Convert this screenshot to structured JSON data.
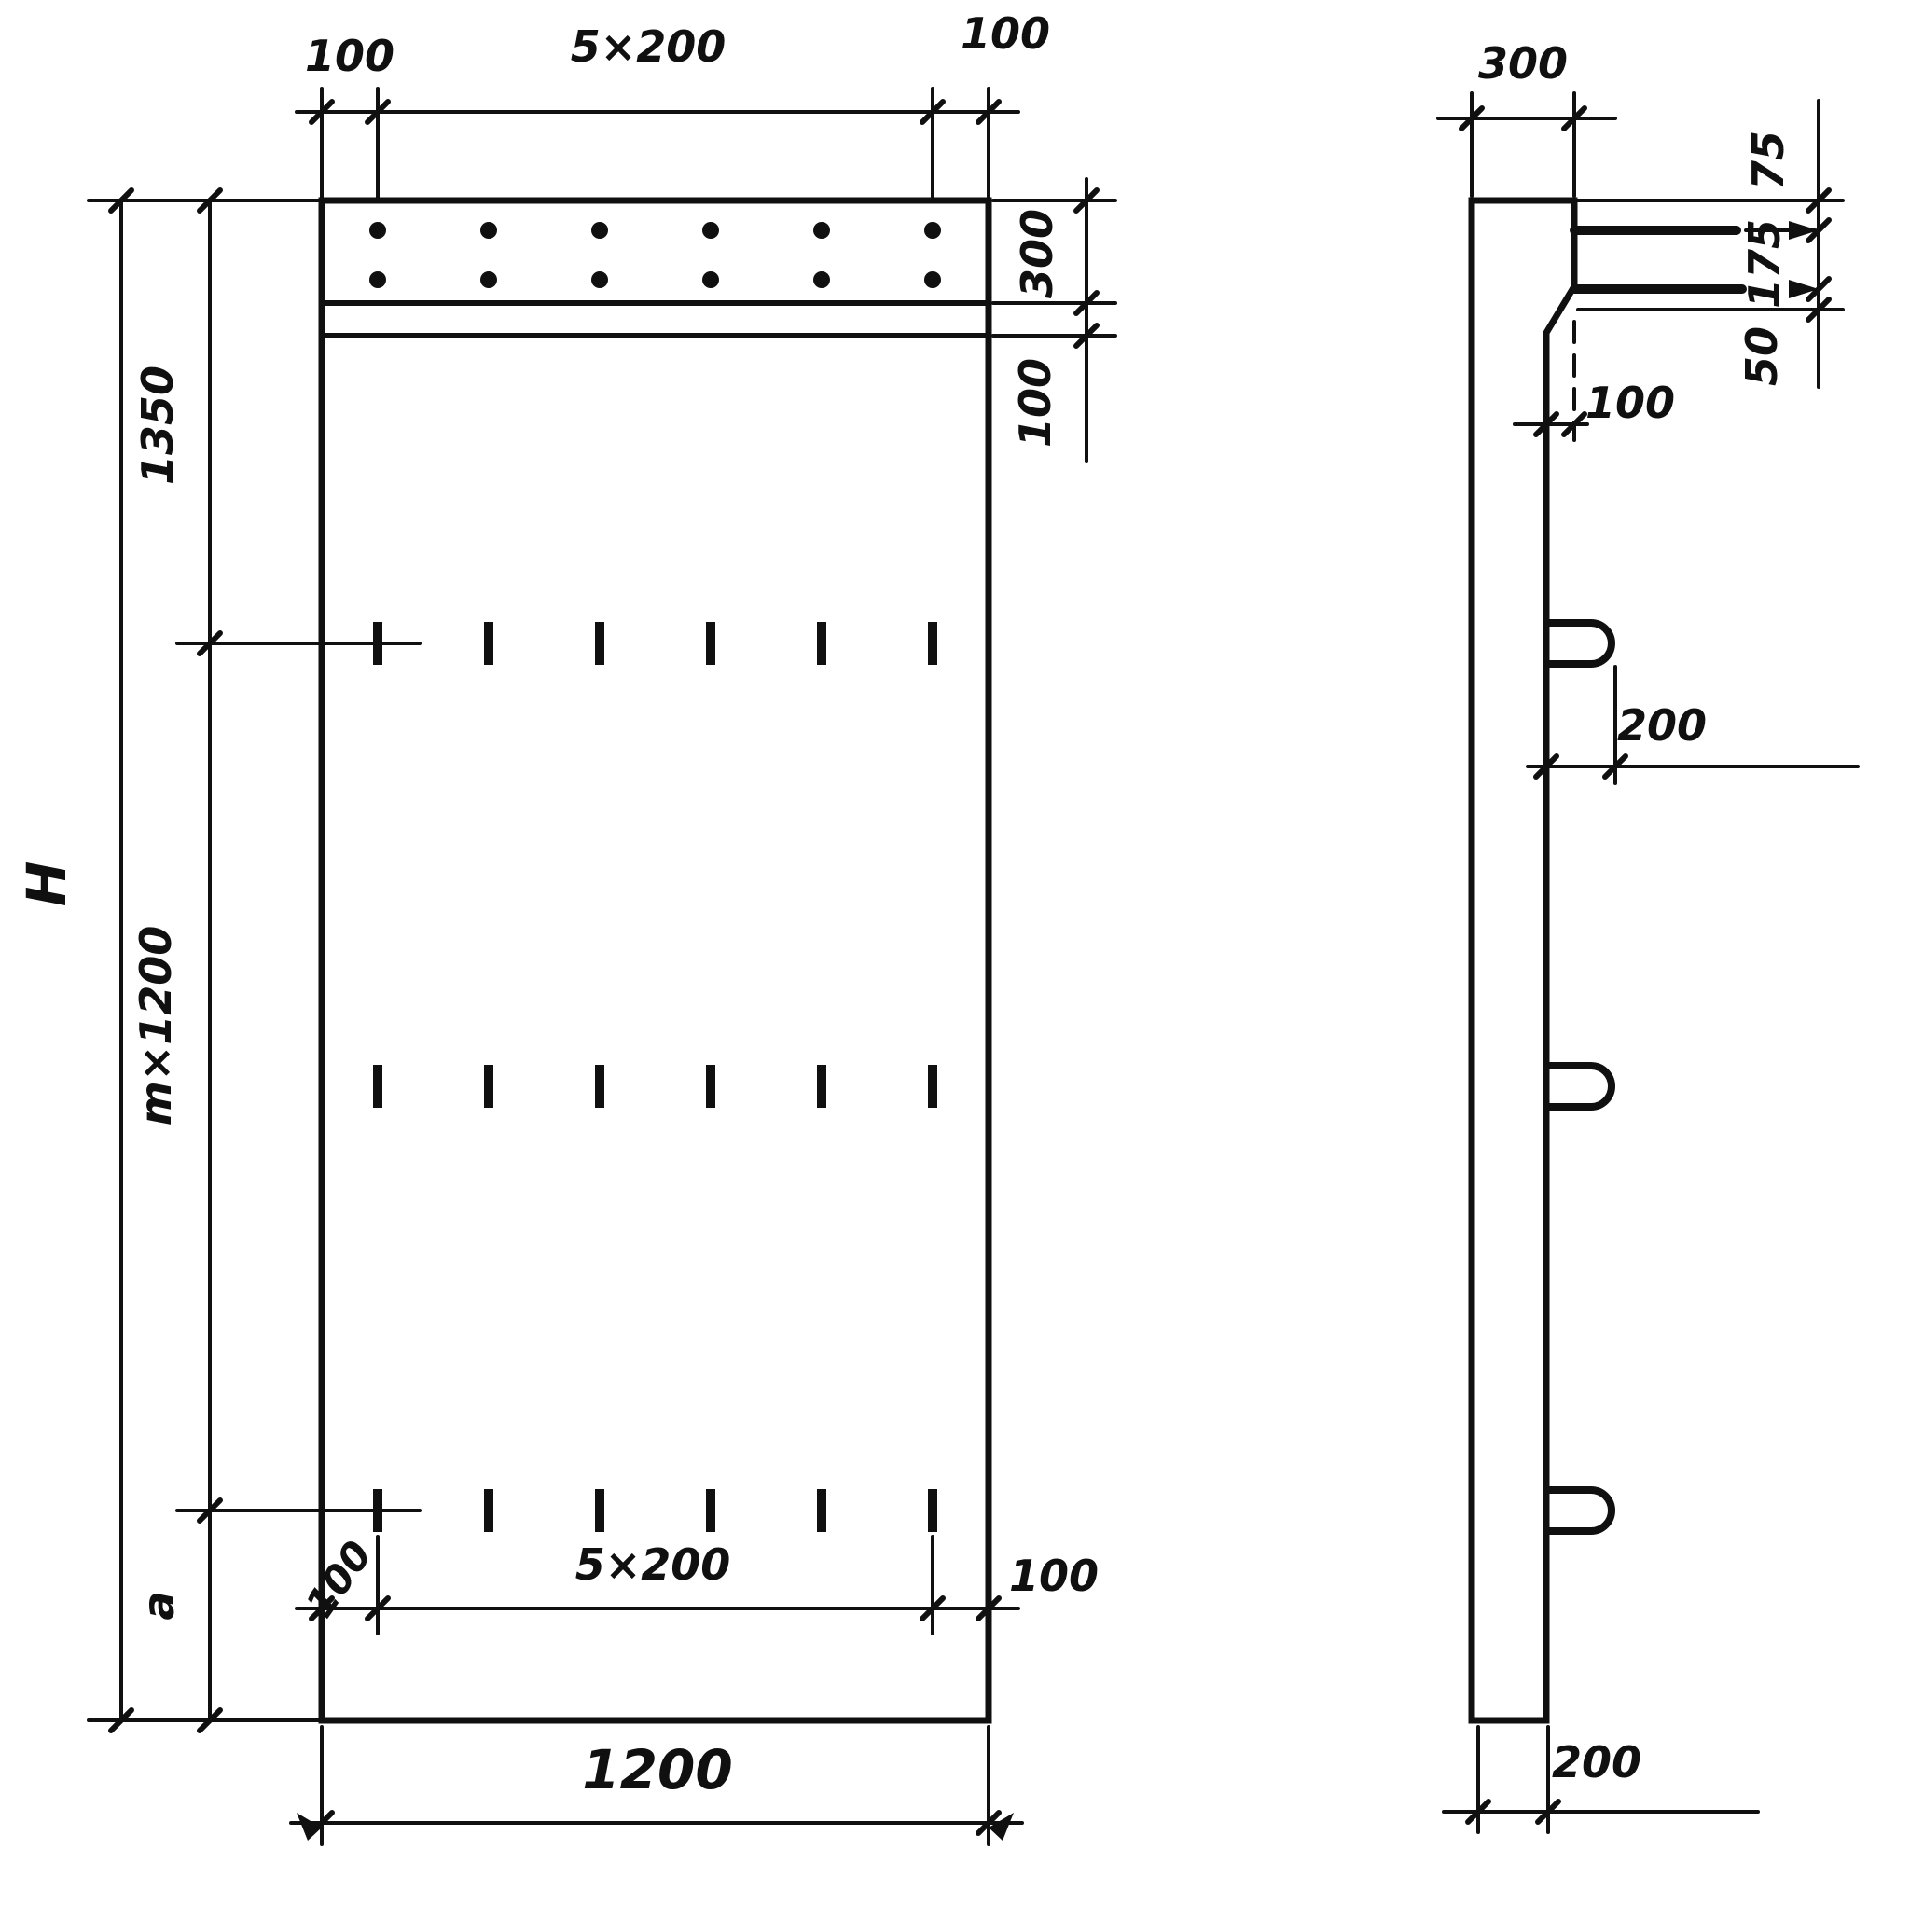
{
  "drawing": {
    "title": "Reinforced concrete panel — front and side views",
    "front_view": {
      "top_dims": {
        "left": "100",
        "center": "5×200",
        "right": "100"
      },
      "right_dims": {
        "strip_height": "300",
        "below_strip": "100"
      },
      "left_dims": {
        "overall": "H",
        "top_segment": "1350",
        "middle_segment": "m×1200",
        "bottom_segment": "a"
      },
      "bottom_dims": {
        "inner_left": "100",
        "inner_center": "5×200",
        "inner_right": "100",
        "overall_width": "1200"
      }
    },
    "side_view": {
      "top_width": "300",
      "right_dims": {
        "top": "75",
        "middle": "175",
        "bottom": "50"
      },
      "step_width": "100",
      "loop_protrusion": "200",
      "bottom_thickness": "200"
    }
  }
}
